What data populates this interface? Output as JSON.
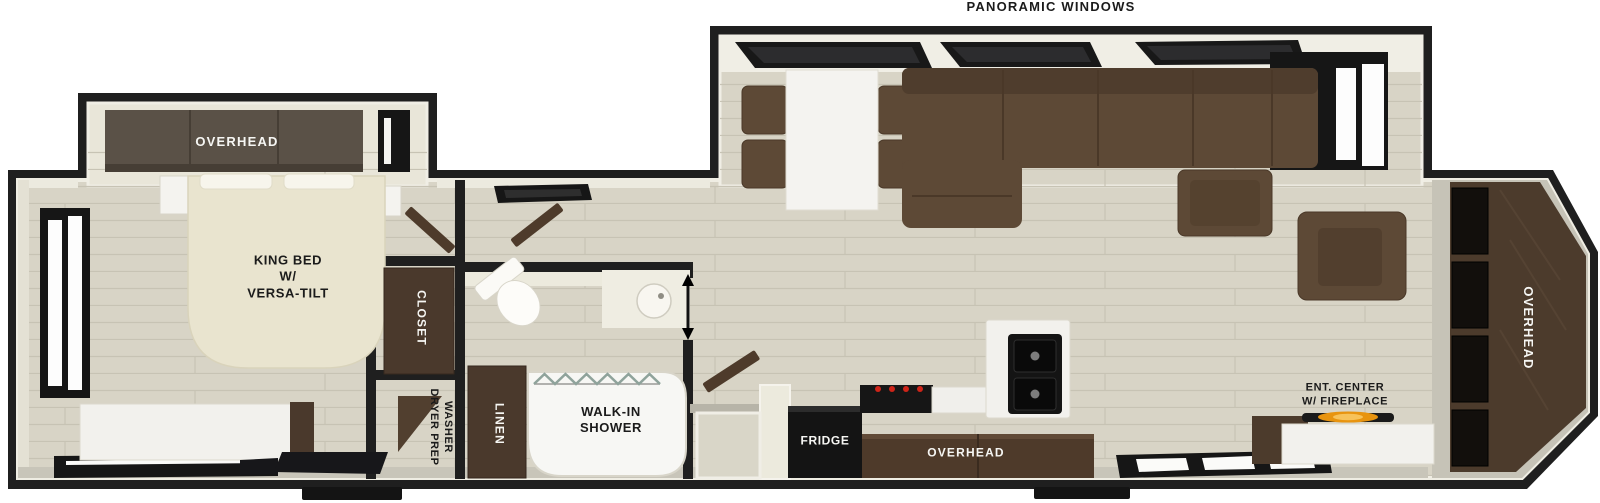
{
  "annotations": {
    "panoramic_windows": "PANORAMIC WINDOWS"
  },
  "rooms": {
    "bedroom": {
      "overhead_cabinet": "OVERHEAD",
      "bed": {
        "line1": "KING BED",
        "line2": "W/",
        "line3": "VERSA-TILT"
      },
      "closet": "CLOSET",
      "washer_prep": {
        "line1": "WASHER",
        "line2": "DRYER PREP"
      }
    },
    "bathroom": {
      "linen": "LINEN",
      "shower": {
        "line1": "WALK-IN",
        "line2": "SHOWER"
      }
    },
    "kitchen": {
      "fridge": "FRIDGE",
      "overhead_cabinet": "OVERHEAD"
    },
    "living": {
      "ent_center": {
        "line1": "ENT. CENTER",
        "line2": "W/ FIREPLACE"
      },
      "rear_overhead": "OVERHEAD"
    }
  },
  "colors": {
    "wall": "#1f1f1f",
    "floor": "#d8d4c6",
    "plank_line": "#c7c3b4",
    "cap_floor": "#c6c3b7",
    "cabinet_walnut": "#4c3a2b",
    "cabinet_gray_brown": "#5a5147",
    "sofa_brown": "#5d4936",
    "sofa_dark": "#4d3c2c",
    "bed_cream": "#e9e4cf",
    "counter_white": "#f2f1ed",
    "appliance_black": "#141414",
    "burner_red": "#cf2418",
    "flame_orange": "#e8940f",
    "label_dark": "#1b1b1b",
    "label_light": "#f6f6f3"
  }
}
